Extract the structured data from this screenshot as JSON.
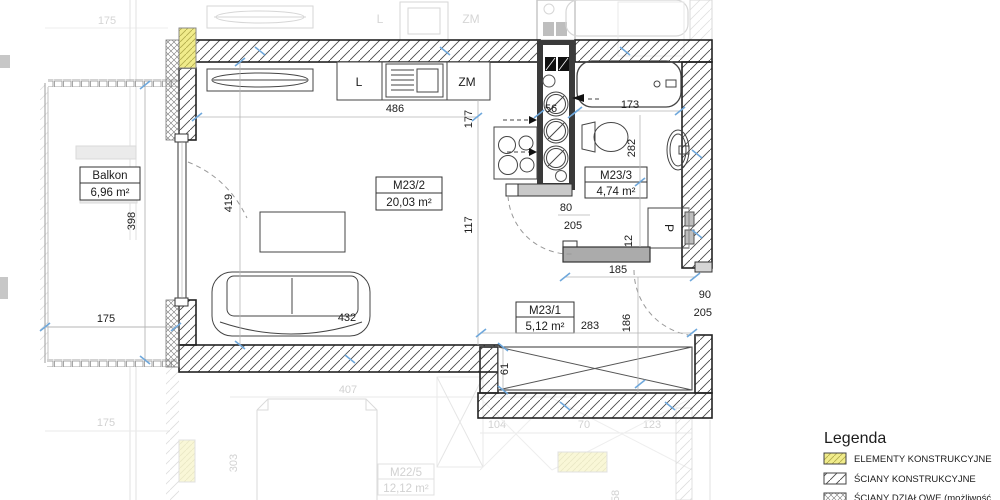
{
  "plan": {
    "rooms": [
      {
        "name": "Balkon",
        "area": "6,96 m²"
      },
      {
        "name": "M23/2",
        "area": "20,03 m²"
      },
      {
        "name": "M23/3",
        "area": "4,74 m²"
      },
      {
        "name": "M23/1",
        "area": "5,12 m²"
      },
      {
        "name": "M22/5",
        "area": "12,12 m²"
      }
    ],
    "labels": {
      "fridge": "L",
      "dishwasher": "ZM",
      "washing_machine": "P",
      "fridge_adjacent": "L",
      "dishwasher_adjacent": "ZM"
    },
    "dims": {
      "balcony_width_adjacent": "175",
      "balcony_width": "175",
      "balcony_width_lower": "175",
      "balcony_height": "398",
      "kitchen_wall": "486",
      "kitchen_depth": "177",
      "shaft_width": "56",
      "bathtub_length": "173",
      "bathroom_length": "282",
      "room_height": "419",
      "room_mid": "117",
      "sofa_width": "432",
      "bath_door_width": "80",
      "bath_door_height": "205",
      "partition_thickness": "12",
      "hall_opening": "185",
      "entry_door_width": "90",
      "entry_door_height": "205",
      "hall_width": "283",
      "hall_depth": "186",
      "wardrobe_depth": "61",
      "bed_width_lower": "407",
      "dim_lower_104": "104",
      "dim_lower_70": "70",
      "dim_lower_123": "123",
      "dim_lower_303": "303",
      "dim_lower_58": "58"
    },
    "legend": {
      "title": "Legenda",
      "items": [
        {
          "label": "ELEMENTY KONSTRUKCYJNE"
        },
        {
          "label": "ŚCIANY KONSTRUKCYJNE"
        },
        {
          "label": "ŚCIANY DZIAŁOWE (możliwość"
        }
      ]
    }
  }
}
